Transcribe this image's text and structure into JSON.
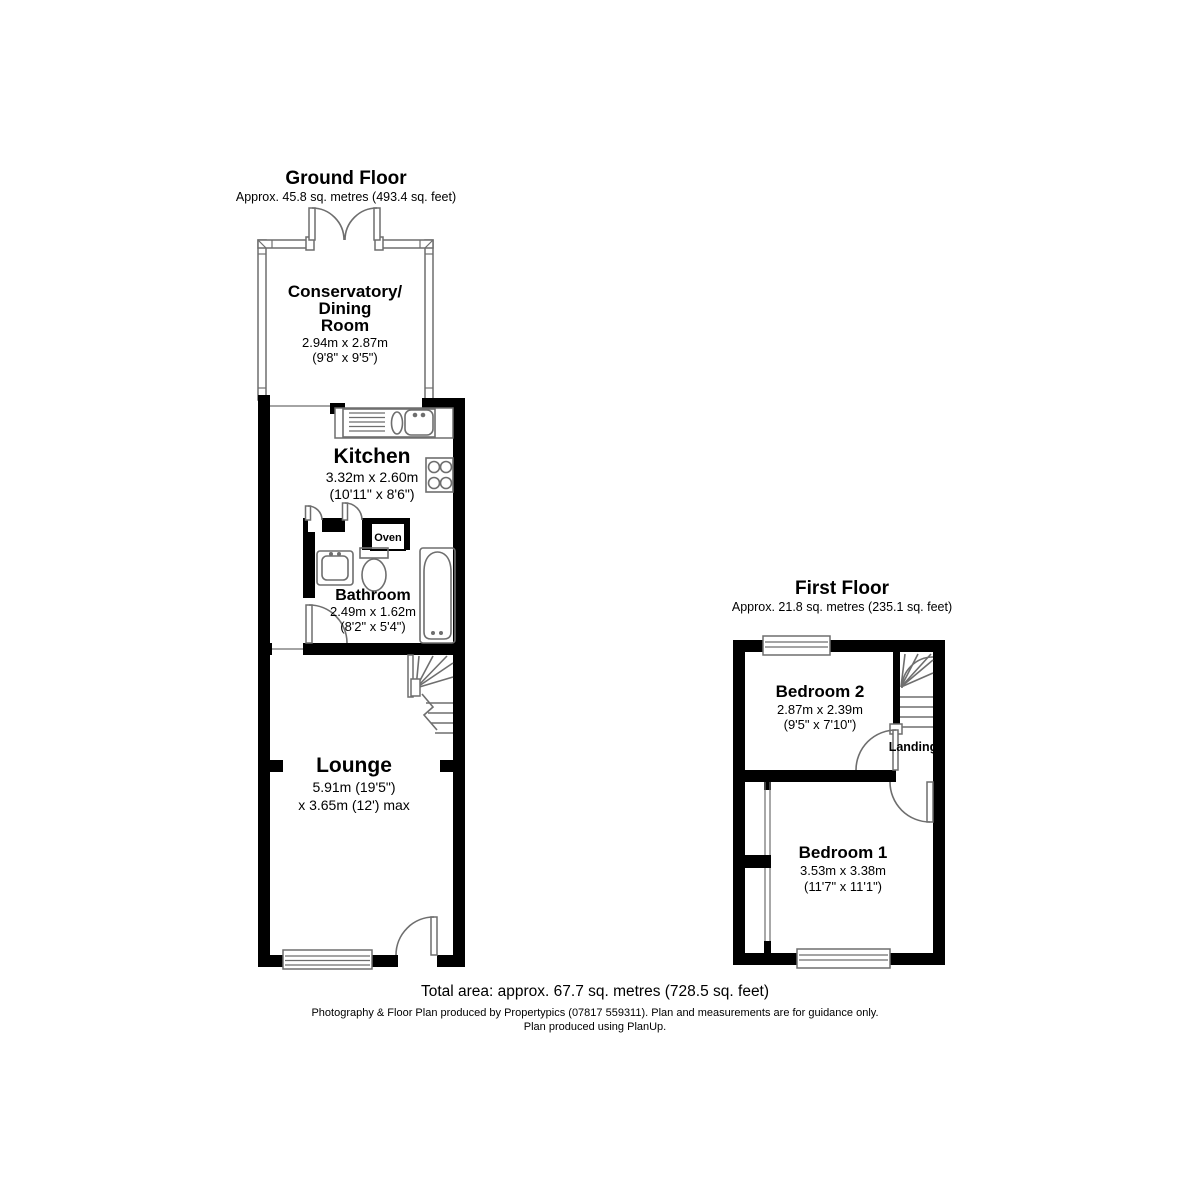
{
  "colors": {
    "wall": "#000000",
    "fixture_line": "#6e6e6e",
    "text": "#000000",
    "background": "#ffffff"
  },
  "ground_floor": {
    "title": "Ground Floor",
    "area": "Approx. 45.8 sq. metres (493.4 sq. feet)",
    "conservatory": {
      "name_line1": "Conservatory/",
      "name_line2": "Dining",
      "name_line3": "Room",
      "dims_m": "2.94m x 2.87m",
      "dims_ft": "(9'8\" x 9'5\")"
    },
    "kitchen": {
      "name": "Kitchen",
      "dims_m": "3.32m x 2.60m",
      "dims_ft": "(10'11\" x 8'6\")"
    },
    "oven": {
      "label": "Oven"
    },
    "bathroom": {
      "name": "Bathroom",
      "dims_m": "2.49m x 1.62m",
      "dims_ft": "(8'2\" x 5'4\")"
    },
    "lounge": {
      "name": "Lounge",
      "dims_m": "5.91m (19'5\")",
      "dims_max": "x 3.65m (12') max"
    }
  },
  "first_floor": {
    "title": "First Floor",
    "area": "Approx. 21.8 sq. metres (235.1 sq. feet)",
    "bedroom2": {
      "name": "Bedroom 2",
      "dims_m": "2.87m x 2.39m",
      "dims_ft": "(9'5\" x 7'10\")"
    },
    "landing": {
      "label": "Landing"
    },
    "bedroom1": {
      "name": "Bedroom 1",
      "dims_m": "3.53m x 3.38m",
      "dims_ft": "(11'7\" x 11'1\")"
    }
  },
  "footer": {
    "total_area": "Total area: approx. 67.7 sq. metres (728.5 sq. feet)",
    "credit": "Photography & Floor Plan produced by Propertypics (07817 559311). Plan and measurements are for guidance only.",
    "software": "Plan produced using PlanUp."
  }
}
